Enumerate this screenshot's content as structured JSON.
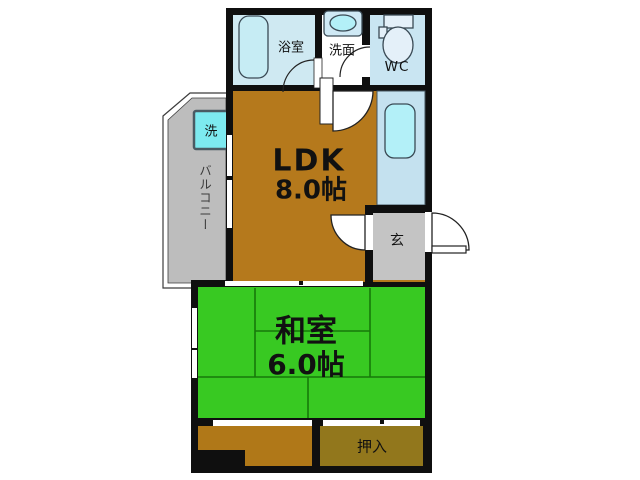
{
  "floorplan": {
    "rooms": {
      "bathroom": {
        "label": "浴室"
      },
      "washroom": {
        "label": "洗面"
      },
      "wc": {
        "label": "WC"
      },
      "balcony": {
        "label": "バルコニー"
      },
      "washer": {
        "label": "洗"
      },
      "ldk": {
        "label": "LDK",
        "size": "8.0帖"
      },
      "genkan": {
        "label": "玄"
      },
      "washitsu": {
        "label": "和室",
        "size": "6.0帖"
      },
      "oshiire": {
        "label": "押入"
      }
    },
    "colors": {
      "wall": "#0f0f0f",
      "ldk_floor": "#b5791c",
      "veranda_floor": "#b07818",
      "washitsu_floor": "#38c922",
      "oshiire_floor": "#92771c",
      "balcony_floor": "#bdbdbd",
      "genkan_floor": "#c4c4c4",
      "bathroom_floor": "#cfe9f2",
      "wc_floor": "#c9e5f2",
      "kitchen_counter": "#c4e1ef",
      "sink": "#b3f0f8",
      "tub": "#c6ecf4",
      "toilet": "#e4f0f9",
      "washer_fill": "#7deaf0"
    }
  }
}
